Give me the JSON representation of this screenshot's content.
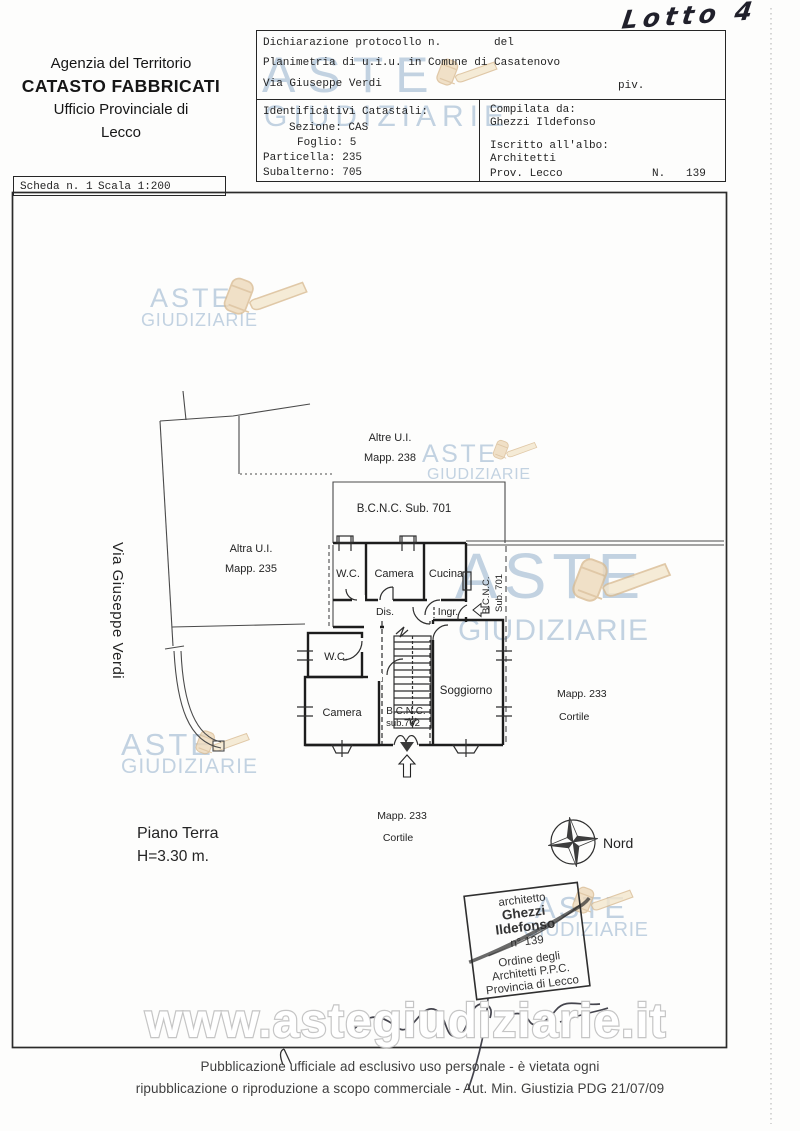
{
  "page": {
    "handwritten_lot": "Lotto 4",
    "footer": {
      "line1": "Pubblicazione ufficiale ad esclusivo uso personale - è vietata ogni",
      "line2": "ripubblicazione o riproduzione a scopo commerciale - Aut. Min. Giustizia PDG 21/07/09"
    }
  },
  "watermark": {
    "word1": "ASTE",
    "word2": "GIUDIZIARIE",
    "url": "www.astegiudiziarie.it",
    "text_color": "#b6c9dc",
    "gavel_color": "#eed9bb"
  },
  "agency_header": {
    "line1": "Agenzia del Territorio",
    "line2": "CATASTO FABBRICATI",
    "line3": "Ufficio Provinciale di",
    "line4": "Lecco"
  },
  "scheda_bar": {
    "scheda": "Scheda n. 1",
    "scala": "Scala 1:200"
  },
  "declaration_table": {
    "protocol_label": "Dichiarazione protocollo n.",
    "del_label": "del",
    "planimetria_line": "Planimetria di u.i.u. in Comune di Casatenovo",
    "street_line": "Via Giuseppe Verdi",
    "piv_label": "piv.",
    "identificativi_title": "Identificativi Catastali:",
    "sezione": "Sezione: CAS",
    "foglio": "Foglio: 5",
    "particella": "Particella: 235",
    "subalterno": "Subalterno: 705",
    "compilata_label": "Compilata da:",
    "compilata_name": "Ghezzi Ildefonso",
    "albo_label": "Iscritto all'albo:",
    "albo_value": "Architetti",
    "prov_label": "Prov. Lecco",
    "num_label": "N.",
    "num_value": "139"
  },
  "floor_plan": {
    "street_label": "Via Giuseppe Verdi",
    "altre_ui": "Altre U.I.",
    "mapp_238": "Mapp. 238",
    "bcnc_sub701_title": "B.C.N.C.   Sub. 701",
    "altra_ui": "Altra U.I.",
    "mapp_235": "Mapp. 235",
    "wc_top": "W.C.",
    "camera_top": "Camera",
    "cucina": "Cucina",
    "dis": "Dis.",
    "ingr": "Ingr.",
    "bcnc_vertical": "B.C.N.C.",
    "sub701_vertical": "Sub. 701",
    "wc_lower": "W.C.",
    "camera_lower": "Camera",
    "soggiorno": "Soggiorno",
    "bcnc_702": "B.C.N.C.",
    "sub_702": "sub.702",
    "mapp_233": "Mapp. 233",
    "cortile": "Cortile",
    "floor_label": "Piano Terra",
    "floor_height": "H=3.30 m.",
    "north_label": "Nord"
  },
  "stamp": {
    "profession": "architetto",
    "name_line1": "Ghezzi",
    "name_line2": "Ildefonso",
    "number": "n° 139",
    "order_line1": "Ordine degli",
    "order_line2": "Architetti P.P.C.",
    "order_line3": "Provincia di Lecco"
  }
}
